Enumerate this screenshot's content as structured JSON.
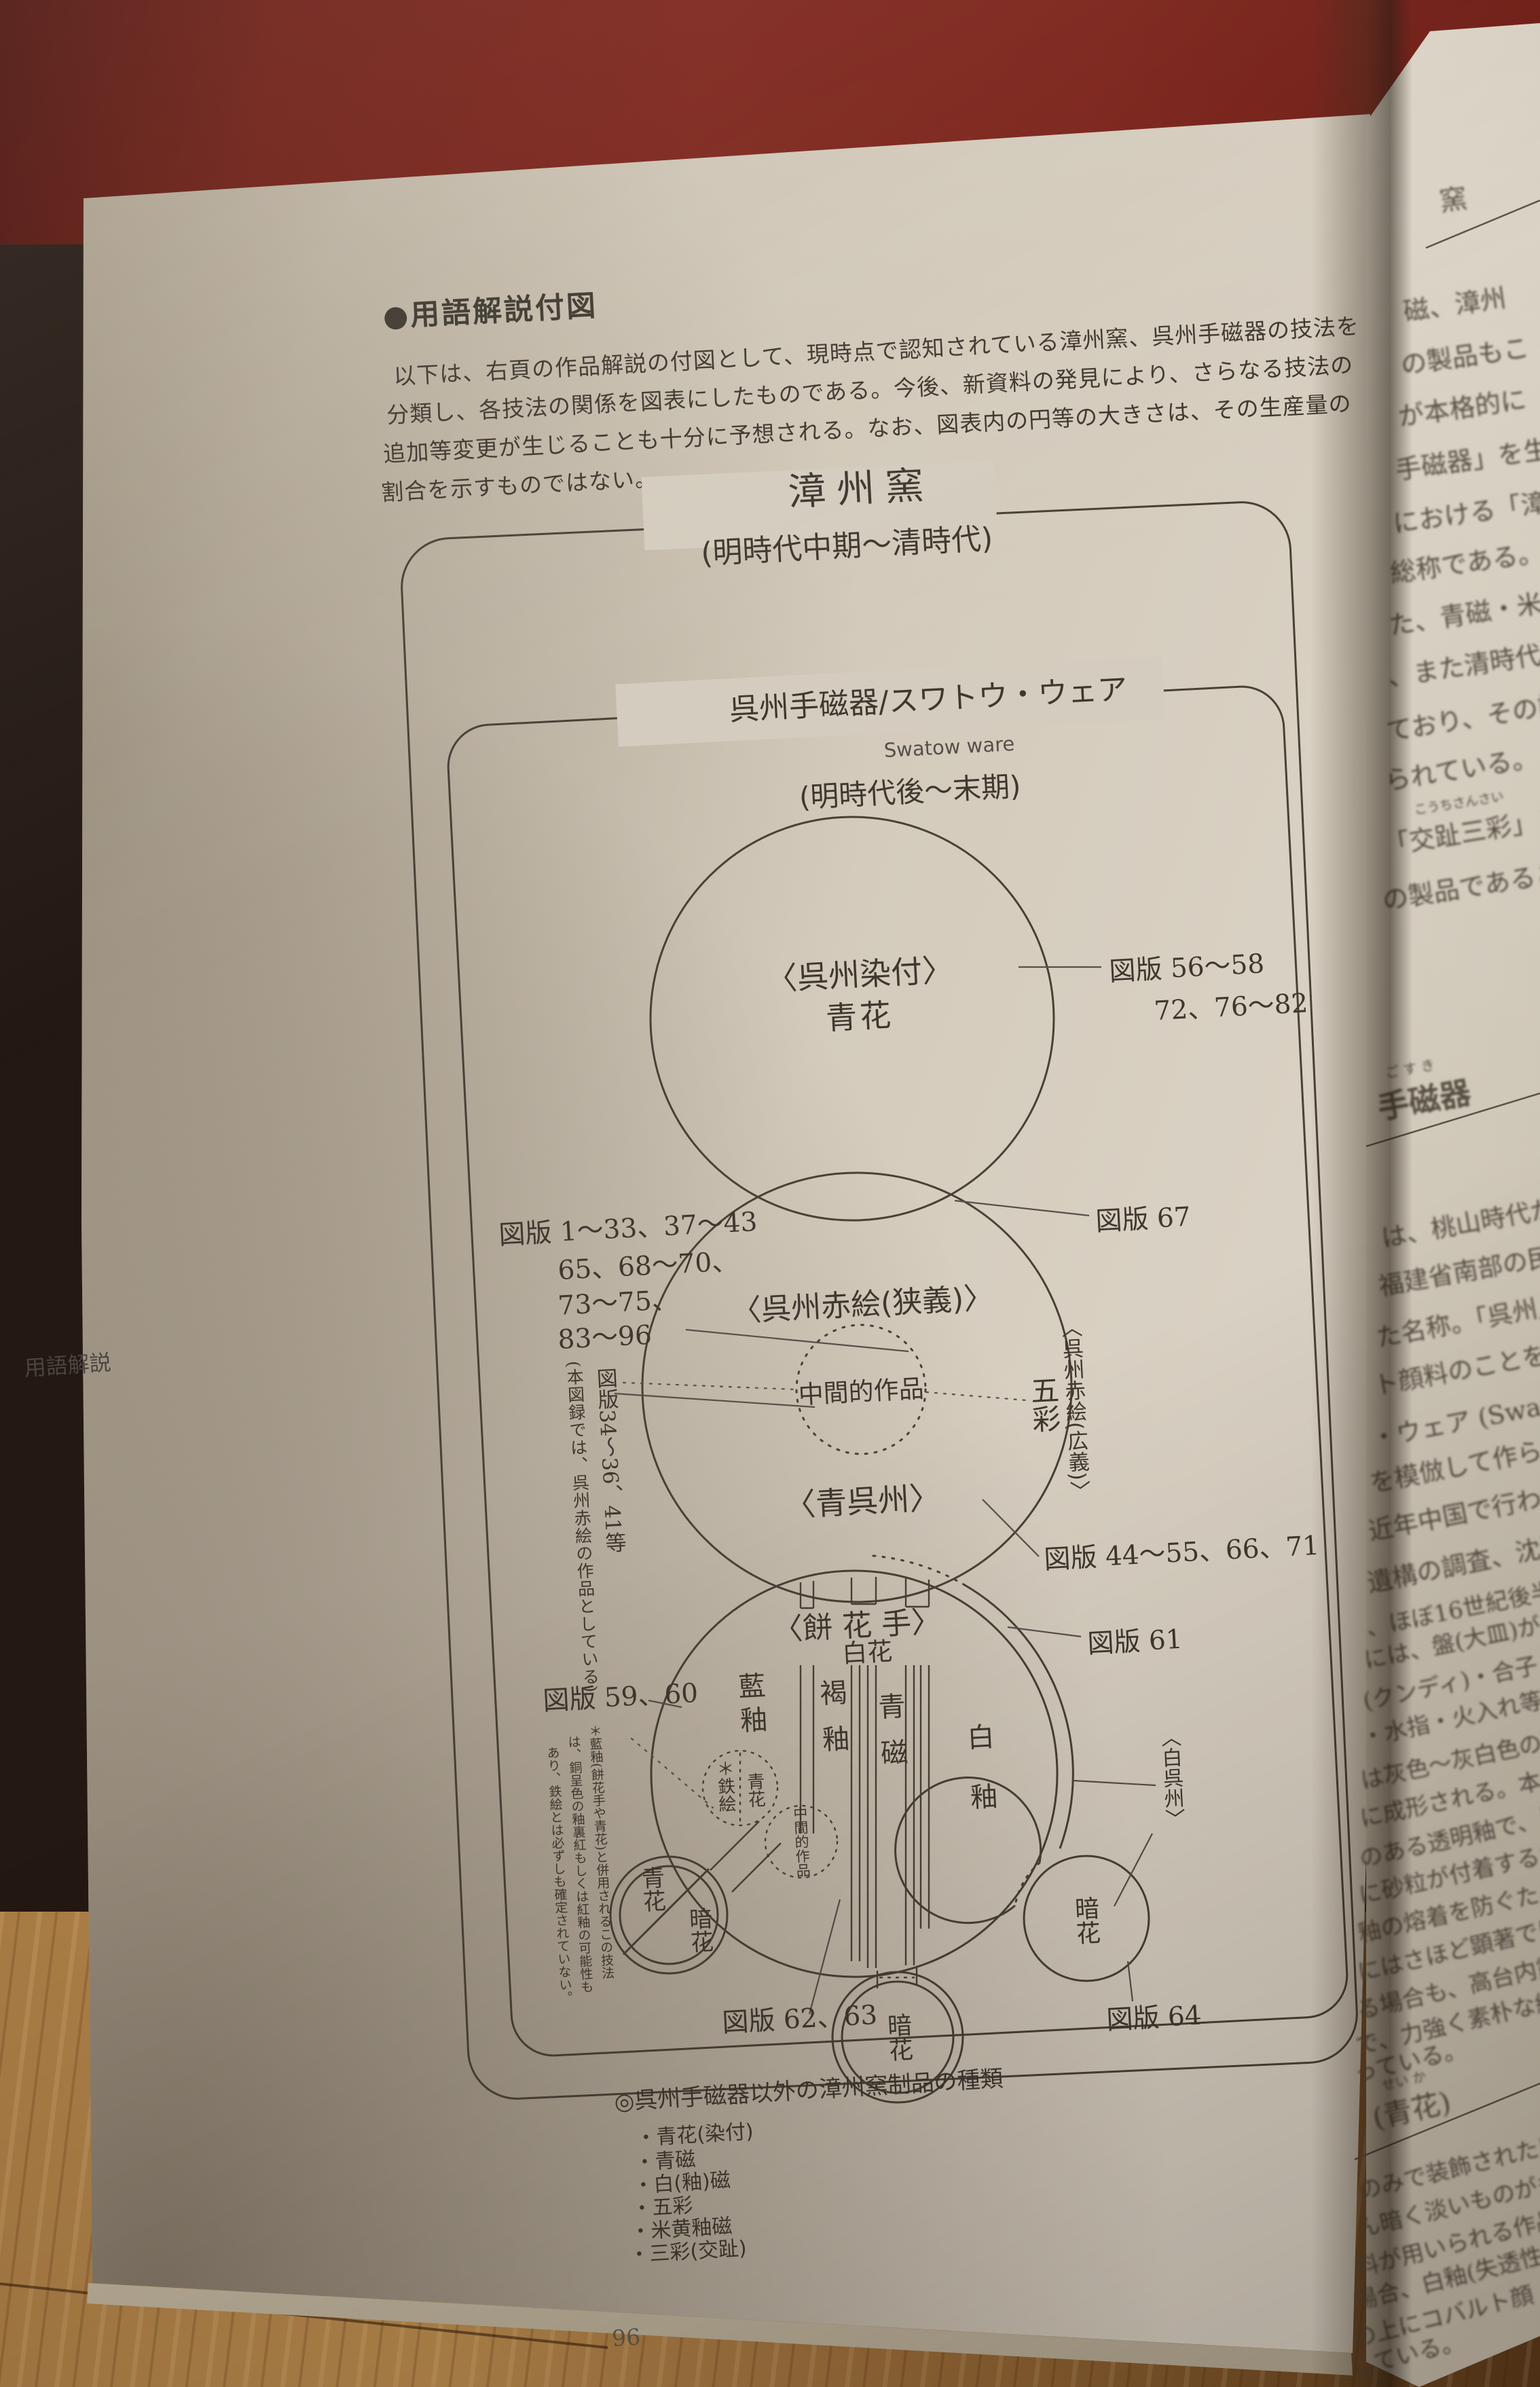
{
  "frame": {
    "page_number": "96",
    "margin_label": "用語解説"
  },
  "heading": {
    "title": "●用語解説付図",
    "lines": [
      "以下は、右頁の作品解説の付図として、現時点で認知されている漳州窯、呉州手磁器の技法を",
      "分類し、各技法の関係を図表にしたものである。今後、新資料の発見により、さらなる技法の",
      "追加等変更が生じることも十分に予想される。なお、図表内の円等の大きさは、その生産量の",
      "割合を示すものではない。"
    ]
  },
  "diagram": {
    "outer_title": "漳州窯",
    "outer_period": "(明時代中期〜清時代)",
    "inner_title": "呉州手磁器/スワトウ・ウェア",
    "inner_subtitle": "Swatow ware",
    "inner_period": "(明時代後〜末期)",
    "sometsuke": {
      "name": "〈呉州染付〉",
      "tech": "青花",
      "plates1": "図版 56〜58",
      "plates2": "72、76〜82"
    },
    "akae": {
      "name": "〈呉州赤絵(狭義)〉",
      "middle": "中間的作品",
      "plates_l1": "図版 1〜33、37〜43",
      "plates_l2": "65、68〜70、",
      "plates_l3": "73〜75、",
      "plates_l4": "83〜96",
      "plates_right": "図版 67",
      "broad": "〈呉州赤絵(広義)〉",
      "gosai": "五彩",
      "note_col1": "図版34〜36、41等",
      "note_col2": "(本図録では、呉州赤絵の作品としている)"
    },
    "aogosu": {
      "name": "〈青呉州〉",
      "plates": "図版 44〜55、66、71"
    },
    "blob": {
      "mochihanade": "〈餅 花 手〉",
      "hakka": "白花",
      "ranyu": "藍釉",
      "katsuyu": "褐釉",
      "seiji": "青磁",
      "hakuyu": "白釉",
      "tetsue": "＊鉄絵",
      "seika_small": "青花",
      "chukan": "中間的作品",
      "seika_circle": "青花",
      "anka_left": "暗花",
      "anka_bottom": "暗花",
      "anka_right": "暗花",
      "shirogosu": "〈白呉州〉",
      "plates_59": "図版 59、60",
      "plates_61": "図版 61",
      "plates_62": "図版 62、63",
      "plates_64": "図版 64",
      "note_col1": "＊藍釉(餅花手や青花)と併用されるこの技法",
      "note_col2": "は、銅呈色の釉裏紅もしくは紅釉の可能性も",
      "note_col3": "あり、鉄絵とは必ずしも確定されていない。"
    },
    "legend": {
      "title": "◎呉州手磁器以外の漳州窯制品の種類",
      "items": [
        "・青花(染付)",
        "・青磁",
        "・白(釉)磁",
        "・五彩",
        "・米黄釉磁",
        "・三彩(交趾)"
      ]
    }
  },
  "right_page": {
    "top_header": "窯",
    "top_lines": [
      "磁、漳州",
      "の製品もこ",
      "が本格的に",
      "手磁器」を生",
      "における「漳州",
      "総称である。",
      "た、青磁・米",
      "、また清時代",
      "ており、その語",
      "られている。"
    ],
    "furigana_kochi": "こうちさんさい",
    "kochi_line": "「交趾三彩」と",
    "kochi_line2": "の製品であること",
    "section1_furigana": "ご す き",
    "section1": "手磁器",
    "mid_lines_a": [
      "は、桃山時代から",
      "福建省南部の民窯",
      "た名称。「呉州」、ま",
      "ト顔料のことを指す",
      "・ウェア (Swatow wa",
      "を模倣して作られ、",
      "近年中国で行われて",
      "遺構の調査、沈没船の"
    ],
    "mid_lines_b": [
      "、ほぼ16世紀後半から",
      "には、盤(大皿)が",
      "(クンディ)・合子・",
      "・水指・火入れ等",
      "は灰色〜灰白色の磁胎",
      "に成形される。本焼き",
      "のある透明釉で、「白釉",
      "に砂粒が付着するため",
      "釉の熔着を防ぐため、",
      "にはさほど顕著ではな",
      "る場合も、高台内露胎",
      "で、力強く素朴な絵",
      "っている。"
    ],
    "section2_furigana": "せい か",
    "section2": "(青花)",
    "bottom_lines": [
      "のみで装飾された呉州",
      "ん暗く淡いものが多い",
      "料が用いられる作品も",
      "場合、白釉(失透性",
      "の上にコバルト顔",
      "している。"
    ]
  }
}
